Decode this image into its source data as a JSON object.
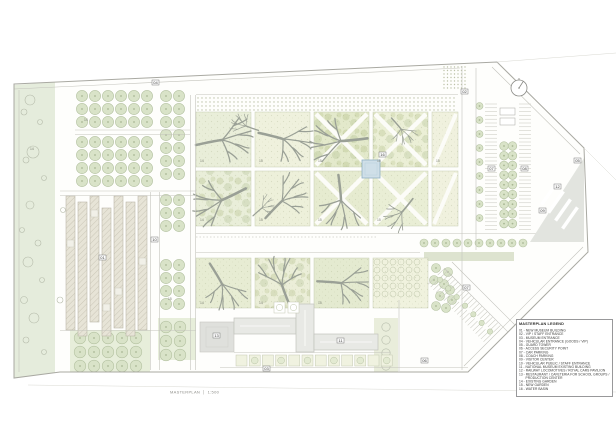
{
  "legend": {
    "title": "MASTERPLAN LEGEND",
    "items": [
      {
        "num": "01",
        "label": "NEW MUSEUM BUILDING"
      },
      {
        "num": "02",
        "label": "VIP / STAFF ENTRANCE"
      },
      {
        "num": "03",
        "label": "MUSEUM ENTRANCE"
      },
      {
        "num": "04",
        "label": "VEHICULAR ENTRANCE (GOODS / VIP)"
      },
      {
        "num": "05",
        "label": "GUARD TOWER"
      },
      {
        "num": "06",
        "label": "ACCESS SECURITY POINT"
      },
      {
        "num": "07",
        "label": "CAR PARKING"
      },
      {
        "num": "08",
        "label": "COACH PARKING"
      },
      {
        "num": "09",
        "label": "VISITOR CENTER"
      },
      {
        "num": "10",
        "label": "VEHICULAR PUBLIC / STAFF ENTRANCE"
      },
      {
        "num": "11",
        "label": "NATIONAL MUSEUM EXISTING BUILDING"
      },
      {
        "num": "12",
        "label": "RAILWAY LOCOMOTIVES / ROYAL CARS PAVILION"
      },
      {
        "num": "13",
        "label": "RESTAURANT / CAFETERIA FOR SCHOOL GROUPS / PRODUCTION CENTER"
      },
      {
        "num": "14",
        "label": "EXISTING GARDEN"
      },
      {
        "num": "15",
        "label": "NEW GARDEN"
      },
      {
        "num": "16",
        "label": "WATER BASIN"
      }
    ]
  },
  "caption": {
    "title": "MASTERPLAN",
    "scale": "1:500"
  },
  "plan": {
    "markers": [
      {
        "num": "04",
        "x": 152,
        "y": 80
      },
      {
        "num": "02",
        "x": 461,
        "y": 89
      },
      {
        "num": "05",
        "x": 574,
        "y": 158
      },
      {
        "num": "07",
        "x": 488,
        "y": 166
      },
      {
        "num": "08",
        "x": 521,
        "y": 166
      },
      {
        "num": "12",
        "x": 554,
        "y": 184
      },
      {
        "num": "09",
        "x": 539,
        "y": 208
      },
      {
        "num": "07",
        "x": 463,
        "y": 285
      },
      {
        "num": "10",
        "x": 151,
        "y": 237
      },
      {
        "num": "01",
        "x": 99,
        "y": 255
      },
      {
        "num": "11",
        "x": 337,
        "y": 338
      },
      {
        "num": "13",
        "x": 213,
        "y": 333
      },
      {
        "num": "03",
        "x": 263,
        "y": 366
      },
      {
        "num": "06",
        "x": 421,
        "y": 358
      },
      {
        "num": "16",
        "x": 379,
        "y": 152
      }
    ],
    "parcel_labels": [
      {
        "num": "14",
        "x": 200,
        "y": 162
      },
      {
        "num": "15",
        "x": 259,
        "y": 162
      },
      {
        "num": "15",
        "x": 318,
        "y": 162
      },
      {
        "num": "15",
        "x": 377,
        "y": 162
      },
      {
        "num": "15",
        "x": 436,
        "y": 162
      },
      {
        "num": "14",
        "x": 200,
        "y": 221
      },
      {
        "num": "15",
        "x": 259,
        "y": 221
      },
      {
        "num": "15",
        "x": 318,
        "y": 221
      },
      {
        "num": "15",
        "x": 377,
        "y": 221
      },
      {
        "num": "14",
        "x": 200,
        "y": 304
      },
      {
        "num": "14",
        "x": 259,
        "y": 304
      },
      {
        "num": "15",
        "x": 318,
        "y": 304
      },
      {
        "num": "14",
        "x": 30,
        "y": 150
      },
      {
        "num": "14",
        "x": 84,
        "y": 121
      },
      {
        "num": "15",
        "x": 168,
        "y": 300
      }
    ],
    "colors": {
      "existing_garden_strip": "#e5ecdc",
      "garden_parcel_light": "#eff1dd",
      "garden_parcel_dark": "#e3e9cb",
      "tree_canopy": "#d9e3c8",
      "roof_gray": "#e8e9e5",
      "plaza_gray": "#dfe0dc",
      "water_basin": "#cfdfe8",
      "road_line": "#c3c3bc"
    }
  }
}
